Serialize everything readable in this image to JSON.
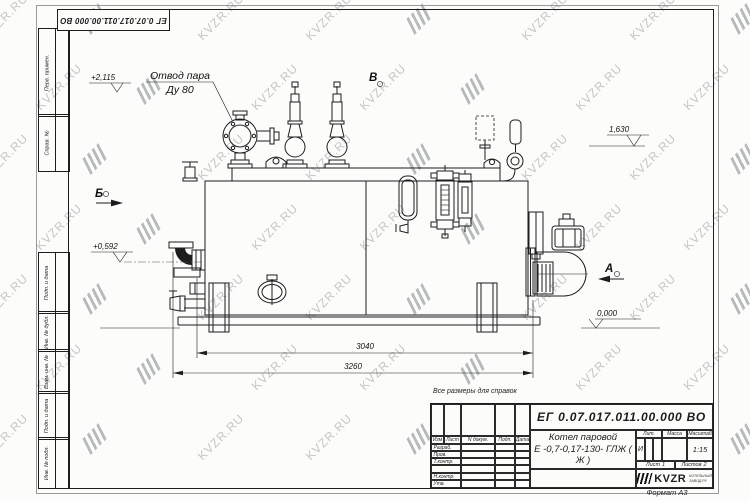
{
  "doc": {
    "number": "ЕГ 0.07.017.011.00.000  ВО",
    "format_label": "Формат А3",
    "reference_note": "Все размеры для справок"
  },
  "title_block": {
    "product_name_line1": "Котел паровой",
    "product_name_line2": "Е -0,7-0,17-130- ГЛЖ ( Ж )",
    "col_headers": {
      "izm": "Изм",
      "list": "Лист",
      "doc": "N докум.",
      "podp": "Подп.",
      "data": "Дата"
    },
    "roles": {
      "razrab": "Разраб.",
      "prov": "Пров.",
      "tkontr": "Т.контр.",
      "nkontr": "Н.контр.",
      "utv": "Утв."
    },
    "lit_header": "Лит.",
    "mass_header": "Масса",
    "scale_header": "Масштаб",
    "lit_value": "И",
    "scale_value": "1:15",
    "sheet_label": "Лист",
    "sheet_value": "1",
    "sheets_label": "Листов",
    "sheets_value": "2",
    "company": {
      "logo_text": "KVZR",
      "sub_line1": "КОТЕЛЬНЫЙ",
      "sub_line2": "ЗАВОД.РУ"
    }
  },
  "margin_labels": [
    "Перв. примен.",
    "Справ. №",
    "Подп. и дата",
    "Инв. № дубл.",
    "Взам. инв. №",
    "Подп. и дата",
    "Инв. № подл."
  ],
  "callout": {
    "line1": "Отвод пара",
    "line2": "Ду 80"
  },
  "views": {
    "a": "А",
    "b": "Б",
    "v": "В"
  },
  "elevations": {
    "top": "+2,115",
    "right": "1,630",
    "left": "+0,592",
    "base": "0,000"
  },
  "dimensions": {
    "inner": "3040",
    "overall": "3260"
  },
  "watermark": {
    "text": "KVZR.RU"
  }
}
